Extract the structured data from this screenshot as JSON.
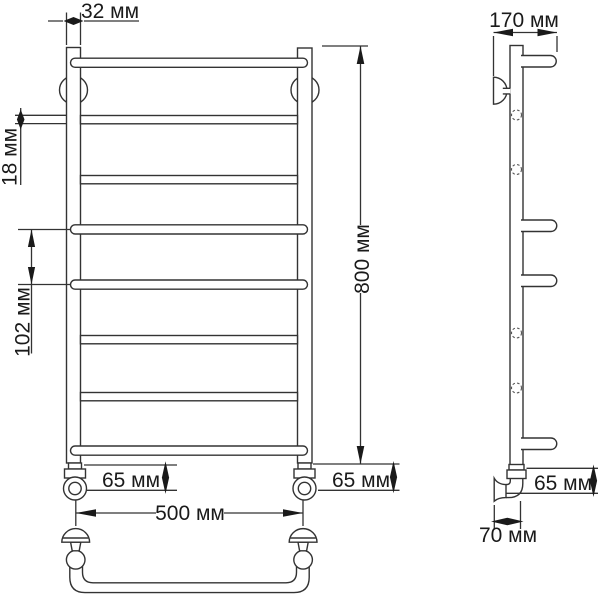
{
  "drawing": {
    "kind": "technical-dimension-diagram",
    "subject": "ladder-towel-rail",
    "unit": "мм",
    "labels": {
      "rail_diameter": "32 мм",
      "rung_diameter": "18 мм",
      "rung_spacing": "102 мм",
      "height": "800 мм",
      "offset_left": "65 мм",
      "offset_right": "65 мм",
      "width": "500 мм",
      "depth": "170 мм",
      "side_offset": "65 мм",
      "wall_offset": "70 мм"
    }
  }
}
